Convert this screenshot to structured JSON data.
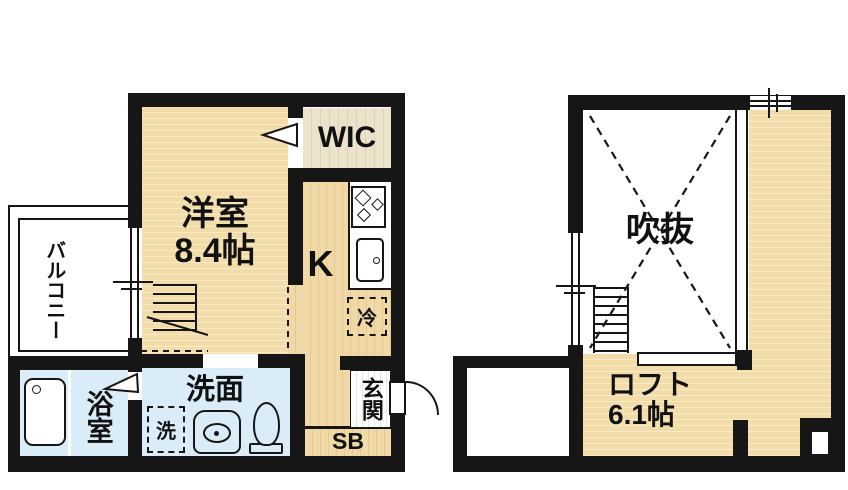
{
  "rooms": {
    "western_room": {
      "label": "洋室",
      "size": "8.4帖"
    },
    "wic": {
      "label": "WIC"
    },
    "kitchen": {
      "label": "K"
    },
    "refrigerator_space": {
      "label": "冷"
    },
    "balcony": {
      "label": "バルコニー"
    },
    "bathroom": {
      "label": "浴室"
    },
    "washroom": {
      "label": "洗面"
    },
    "washing_machine_space": {
      "label": "洗"
    },
    "entrance": {
      "label": "玄関"
    },
    "shoe_box": {
      "label": "SB"
    },
    "atrium_void": {
      "label": "吹抜"
    },
    "loft": {
      "label": "ロフト",
      "size": "6.1帖"
    }
  },
  "colors": {
    "wall": "#161616",
    "wood_floor": "#f2dcaa",
    "wet_area_floor": "#d9ecf7",
    "closet_floor": "#ebe3cb",
    "background": "#ffffff"
  }
}
